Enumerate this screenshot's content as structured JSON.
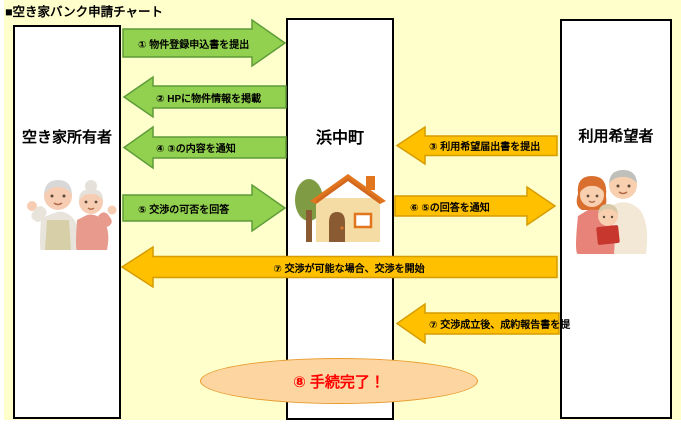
{
  "title": "■空き家バンク申請チャート",
  "columns": {
    "owner": {
      "label": "空き家所有者",
      "illustration": "elderly-couple"
    },
    "town": {
      "label": "浜中町",
      "illustration": "house-with-tree"
    },
    "applicant": {
      "label": "利用希望者",
      "illustration": "family"
    }
  },
  "arrows": [
    {
      "step": "①",
      "label": "① 物件登録申込書を提出",
      "from": "空き家所有者",
      "to": "浜中町",
      "direction": "right",
      "color": "green"
    },
    {
      "step": "②",
      "label": "② HPに物件情報を掲載",
      "from": "浜中町",
      "to": "空き家所有者",
      "direction": "left",
      "color": "green"
    },
    {
      "step": "③",
      "label": "③ 利用希望届出書を提出",
      "from": "利用希望者",
      "to": "浜中町",
      "direction": "left",
      "color": "orange"
    },
    {
      "step": "④",
      "label": "④ ③の内容を通知",
      "from": "浜中町",
      "to": "空き家所有者",
      "direction": "left",
      "color": "green"
    },
    {
      "step": "⑤",
      "label": "⑤ 交渉の可否を回答",
      "from": "空き家所有者",
      "to": "浜中町",
      "direction": "right",
      "color": "green"
    },
    {
      "step": "⑥",
      "label": "⑥ ⑤の回答を通知",
      "from": "浜中町",
      "to": "利用希望者",
      "direction": "right",
      "color": "orange"
    },
    {
      "step": "⑦",
      "label": "⑦ 交渉が可能な場合、交渉を開始",
      "from": "利用希望者",
      "to": "空き家所有者",
      "direction": "left",
      "color": "orange"
    },
    {
      "step": "⑦",
      "label": "⑦ 交渉成立後、成約報告書を提",
      "from": "利用希望者",
      "to": "浜中町",
      "direction": "left",
      "color": "orange"
    }
  ],
  "completion": {
    "label": "⑧ 手続完了！"
  },
  "colors": {
    "background": "#FFFFCC",
    "green_arrow": "#92D050",
    "green_arrow_border": "#5E9C39",
    "orange_arrow": "#FFC000",
    "orange_arrow_border": "#D69C00",
    "ellipse_fill": "#FCD5A0",
    "ellipse_border": "#E89B2D",
    "completion_text": "#FF0000"
  }
}
